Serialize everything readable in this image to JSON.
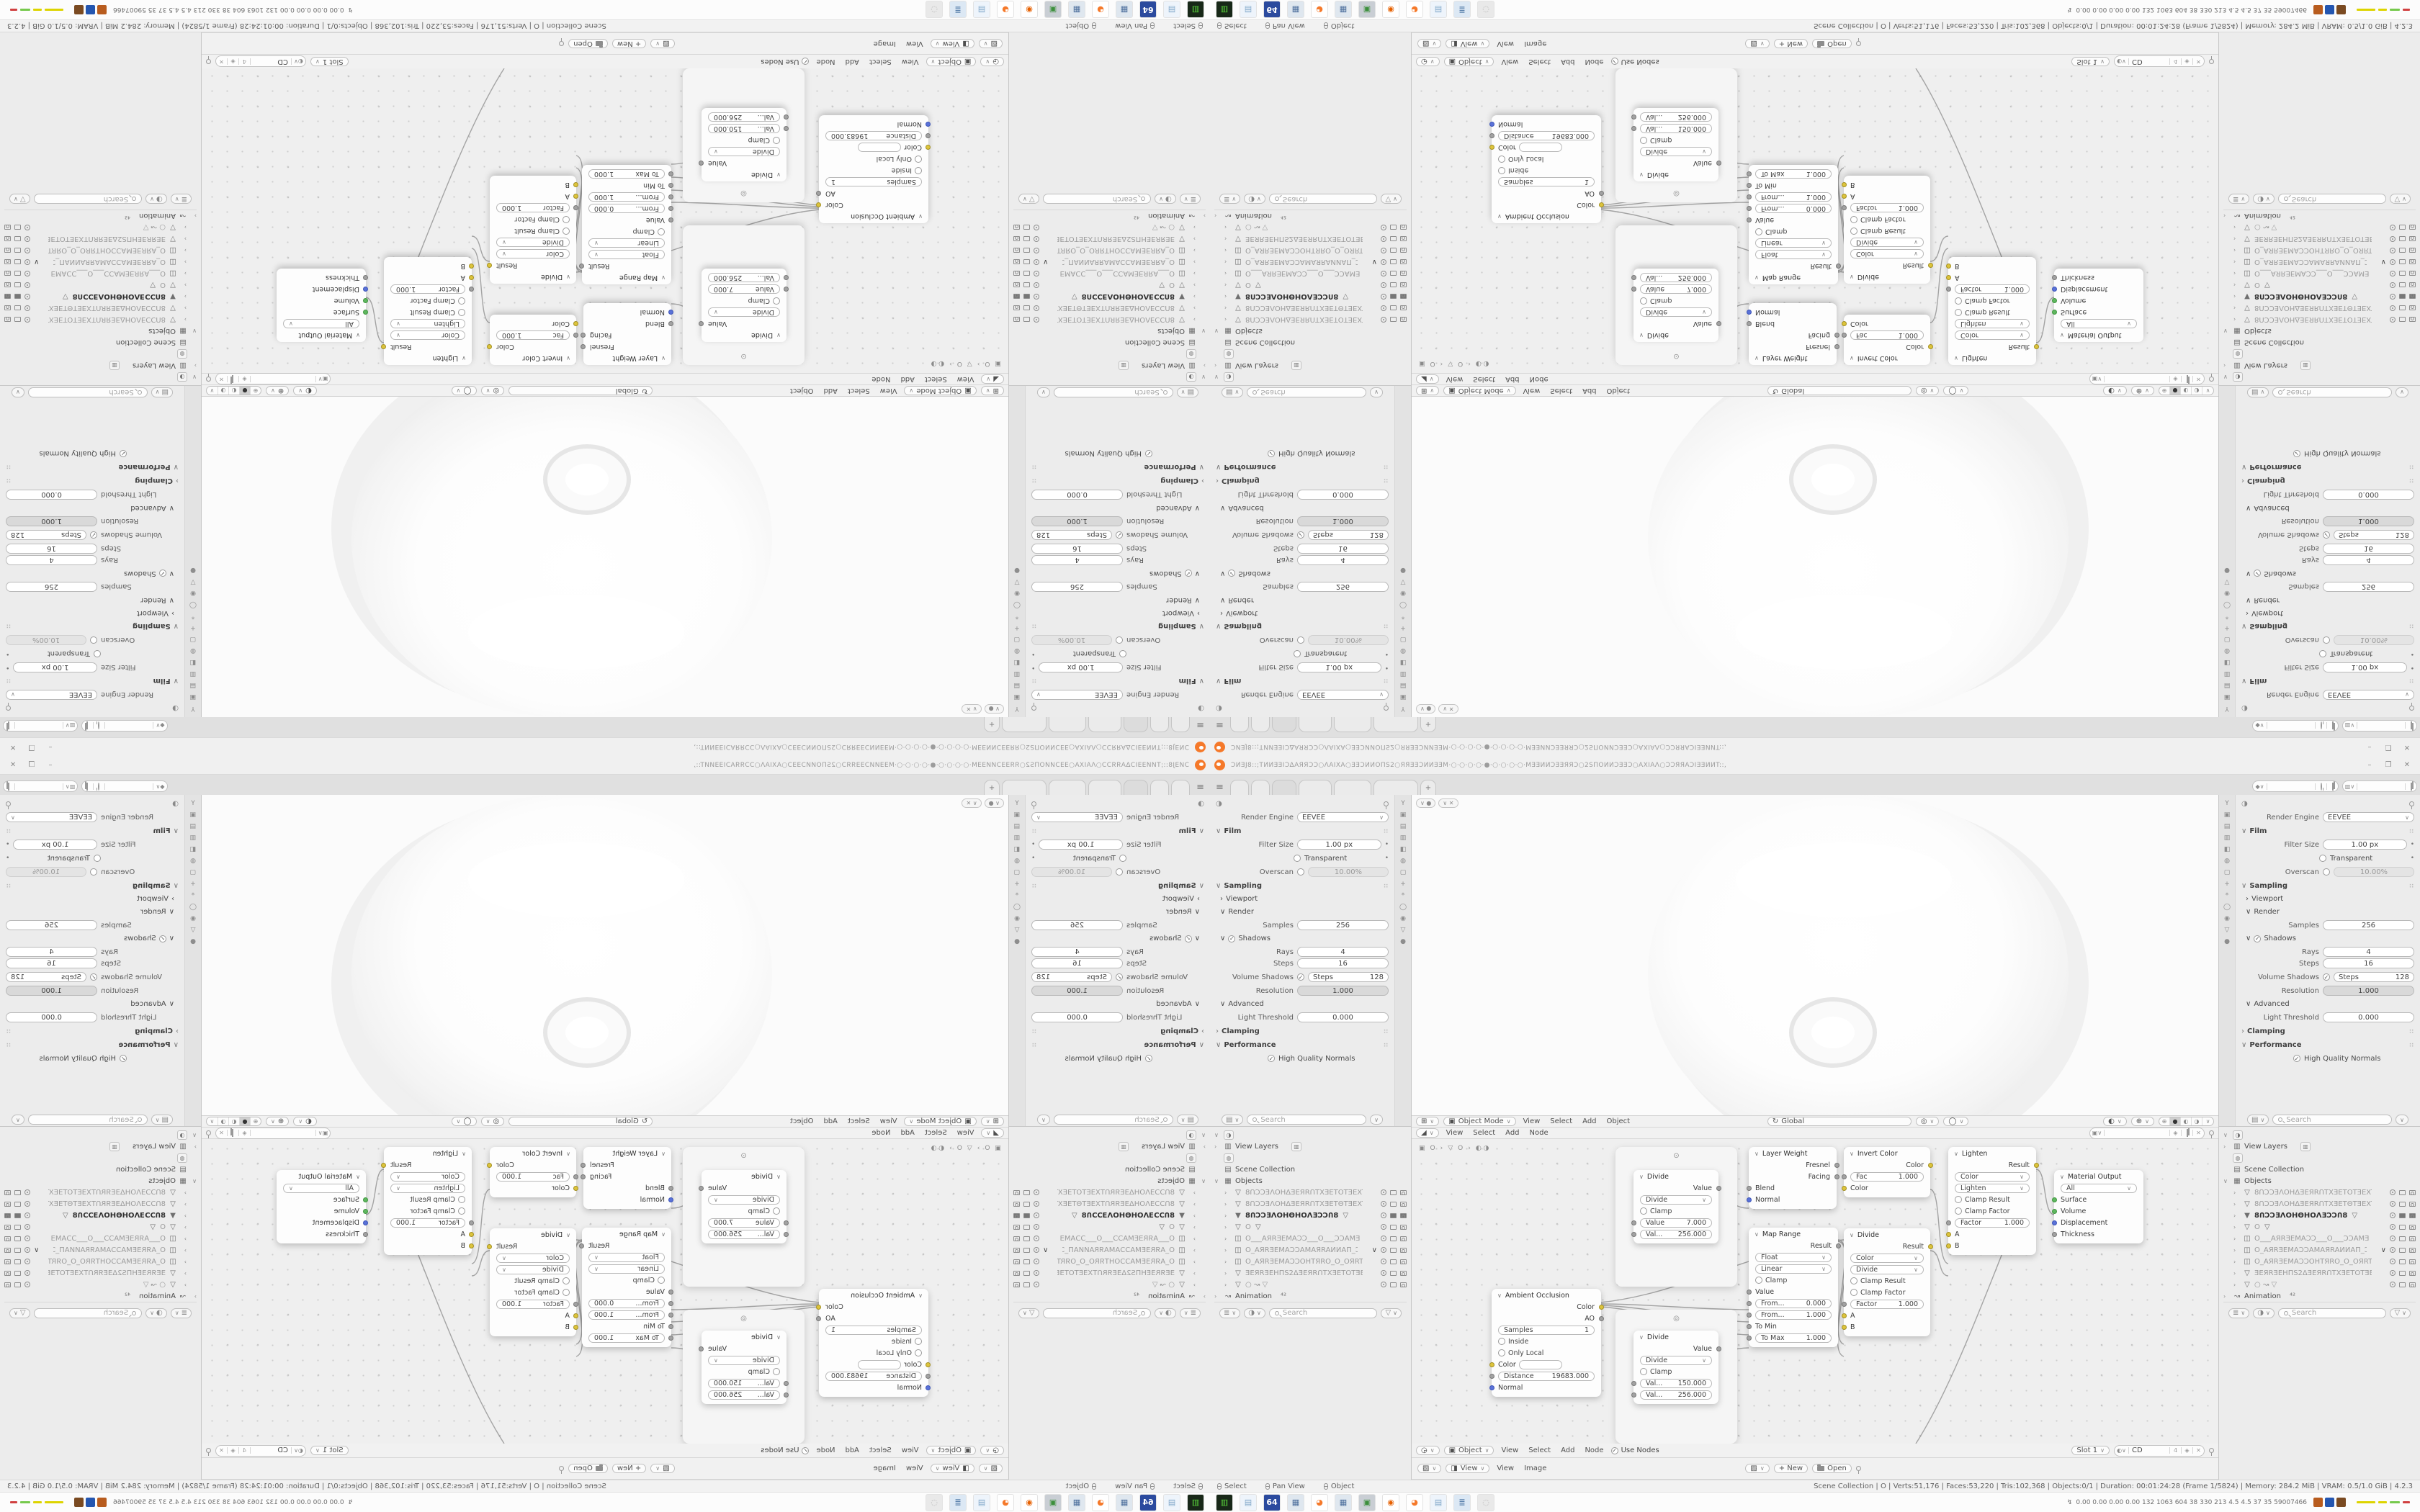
{
  "window": {
    "title": "ƆИƎJ8::;TИИƎƎIƆΔAЯЯƆƆ○ΛAIXA○ƎƎƆИИOΠЅ2○ЯЯƎƎƆИИƎƎM·○·○·○·○·●·○·○·○·○·MƎƎИИƆƎƎЯЯƆ○2ЅΠOИИƆƎƎƆ○AXIAΛ○ƆƆЯЯAƆIƎƎИИT::,",
    "minimize": "–",
    "maximize": "❐",
    "close": "✕"
  },
  "topbar": {
    "menu_icon": "≡",
    "new_tab": "+"
  },
  "props": {
    "render_engine": {
      "label": "Render Engine",
      "value": "EEVEE"
    },
    "film": {
      "label": "Film"
    },
    "filter_size": {
      "label": "Filter Size",
      "value": "1.00 px"
    },
    "transparent": {
      "label": "Transparent"
    },
    "overscan": {
      "label": "Overscan",
      "value": "10.00%"
    },
    "sampling": {
      "label": "Sampling"
    },
    "viewport": {
      "label": "Viewport"
    },
    "render": {
      "label": "Render"
    },
    "samples": {
      "label": "Samples",
      "value": "256"
    },
    "shadows": {
      "label": "Shadows"
    },
    "rays": {
      "label": "Rays",
      "value": "4"
    },
    "steps": {
      "label": "Steps",
      "value": "16"
    },
    "volume_shadows": {
      "label": "Volume Shadows",
      "steps_label": "Steps",
      "value": "128"
    },
    "resolution": {
      "label": "Resolution",
      "value": "1.000"
    },
    "advanced": {
      "label": "Advanced"
    },
    "light_threshold": {
      "label": "Light Threshold",
      "value": "0.000"
    },
    "clamping": {
      "label": "Clamping"
    },
    "performance": {
      "label": "Performance"
    },
    "hq_normals": {
      "label": "High Quality Normals"
    },
    "search_placeholder": "Search",
    "tab_icons": [
      {
        "name": "tool-icon",
        "glyph": "Y"
      },
      {
        "name": "render-icon",
        "glyph": "▣"
      },
      {
        "name": "output-icon",
        "glyph": "▤"
      },
      {
        "name": "viewlayer-icon",
        "glyph": "▥"
      },
      {
        "name": "scene-icon",
        "glyph": "◧"
      },
      {
        "name": "world-icon",
        "glyph": "◍"
      },
      {
        "name": "object-icon",
        "glyph": "▢"
      },
      {
        "name": "modifier-icon",
        "glyph": "+"
      },
      {
        "name": "particles-icon",
        "glyph": "*"
      },
      {
        "name": "physics-icon",
        "glyph": "◯"
      },
      {
        "name": "constraints-icon",
        "glyph": "◉"
      },
      {
        "name": "data-icon",
        "glyph": "▽"
      },
      {
        "name": "material-icon",
        "glyph": "●"
      }
    ]
  },
  "outliner": {
    "view_layers": "View Layers",
    "scene_collection": "Scene Collection",
    "objects_label": "Objects",
    "animation": "Animation",
    "animation_badge": "⁴²",
    "search_placeholder": "Search",
    "objects": [
      {
        "type": "▽",
        "name": "8ՈƆƆƎΛOHΔƎEЯRՈTXƎETOTƎEXT",
        "eye": "",
        "cls": ""
      },
      {
        "type": "▽",
        "name": "8ՈƆƆƎΛOHΔƎEЯRՈTXƎETΘTƎEXT",
        "eye": "",
        "cls": ""
      },
      {
        "type": "▼",
        "name": "8ՈƆƆƎΛOHΘHOΛƎƆƆՈ8",
        "eye": "",
        "cls": "sel",
        "extra": "▽"
      },
      {
        "type": "▽",
        "name": "O",
        "eye": "",
        "cls": "",
        "extra": "▽"
      },
      {
        "type": "◫",
        "name": "O___AЯRƎEMAƆƆ___O___ƆƆAMƎ",
        "eye": "",
        "cls": ""
      },
      {
        "type": "◫",
        "name": "O_AЯRƎEMAƆƆAMAЯRAИИAΠ_Ɔ",
        "eye": "∨",
        "cls": ""
      },
      {
        "type": "◫",
        "name": "O_AЯRƎEMAƆƆOHTЯRO_O_OЯRTH",
        "eye": "",
        "cls": ""
      },
      {
        "type": "▽",
        "name": "ƎEЯRƎEHΠЅ2ΔƎEЯRՈTXƎETOTƎEXT",
        "eye": "",
        "cls": ""
      },
      {
        "type": "▽",
        "name": "○  ↝ ▽",
        "eye": "",
        "cls": ""
      }
    ]
  },
  "viewport_header": {
    "mode": "Object Mode",
    "menus": {
      "view": "View",
      "select": "Select",
      "add": "Add",
      "object": "Object"
    },
    "transform_orientation": "Global"
  },
  "node_header": {
    "menus": {
      "view": "View",
      "select": "Select",
      "add": "Add",
      "node": "Node"
    }
  },
  "breadcrumb": {
    "object": "O",
    "material": "O"
  },
  "nodes": {
    "ao": {
      "title": "Ambient Occlusion",
      "out_color": "Color",
      "out_ao": "AO",
      "samples_label": "Samples",
      "samples_value": "1",
      "inside": "Inside",
      "only_local": "Only Local",
      "color_label": "Color",
      "distance_label": "Distance",
      "distance_value": "19683.000",
      "normal": "Normal"
    },
    "divide1": {
      "title": "Divide",
      "out": "Value",
      "op": "Divide",
      "clamp": "Clamp",
      "v1_label": "Value",
      "v1": "7.000",
      "v2_label": "Val...",
      "v2": "256.000"
    },
    "divide2": {
      "title": "Divide",
      "out": "Value",
      "op": "Divide",
      "clamp": "Clamp",
      "v1_label": "Val...",
      "v1": "150.000",
      "v2_label": "Val...",
      "v2": "256.000"
    },
    "layer_weight": {
      "title": "Layer Weight",
      "out1": "Fresnel",
      "out2": "Facing",
      "in1": "Blend",
      "in2": "Normal"
    },
    "map_range": {
      "title": "Map Range",
      "out": "Result",
      "type": "Float",
      "interp": "Linear",
      "clamp": "Clamp",
      "value": "Value",
      "from_min_label": "From...",
      "from_min": "0.000",
      "from_max_label": "From...",
      "from_max": "1.000",
      "to_min": "To Min",
      "to_max_label": "To Max",
      "to_max": "1.000"
    },
    "invert": {
      "title": "Invert Color",
      "out": "Color",
      "fac_label": "Fac",
      "fac": "1.000",
      "in": "Color"
    },
    "divide_mix": {
      "title": "Divide",
      "out": "Result",
      "mode": "Color",
      "op": "Divide",
      "clamp_result": "Clamp Result",
      "clamp_factor": "Clamp Factor",
      "factor_label": "Factor",
      "factor": "1.000",
      "a": "A",
      "b": "B"
    },
    "lighten": {
      "title": "Lighten",
      "out": "Result",
      "mode": "Color",
      "op": "Lighten",
      "clamp_result": "Clamp Result",
      "clamp_factor": "Clamp Factor",
      "factor_label": "Factor",
      "factor": "1.000",
      "a": "A",
      "b": "B"
    },
    "material_output": {
      "title": "Material Output",
      "target": "All",
      "surface": "Surface",
      "volume": "Volume",
      "displacement": "Displacement",
      "thickness": "Thickness"
    }
  },
  "shader_header": {
    "context": "Object",
    "menus": {
      "view": "View",
      "select": "Select",
      "add": "Add",
      "node": "Node"
    },
    "use_nodes": "Use Nodes",
    "slot": "Slot 1",
    "material_name": "CD",
    "users_count": "4"
  },
  "image_header": {
    "view_menu": "View",
    "menus": {
      "view": "View",
      "image": "Image"
    },
    "new_label": "+ New",
    "open_label": "Open"
  },
  "statusbar": {
    "hints": {
      "select": "Select",
      "pan": "Pan View",
      "object": "Object"
    },
    "stats": "Scene Collection | O | Verts:51,176 | Faces:53,220 | Tris:102,368 | Objects:0/1 | Duration: 00:01:24:28 (Frame 1/5824) | Memory: 284.2 MiB | VRAM: 0.5/1.0 GiB | 4.2.3"
  },
  "taskbar": {
    "perf_numbers": "0.00 0.00 0.00 0.00 132 1063 604 38 330 213 4.5 4.5 37 35 59007466",
    "apps": [
      {
        "name": "drive-app",
        "bg": "#14221247",
        "glyph": "▥",
        "fg": "#58d33a",
        "bgc": "#182818"
      },
      {
        "name": "notepad-app",
        "glyph": "▤",
        "fg": "#7fa6c8",
        "bgc": "#eef4fb"
      },
      {
        "name": "floppy64-app",
        "glyph": "64",
        "fg": "#ffffff",
        "bgc": "#2b4a9e"
      },
      {
        "name": "calculator-app",
        "glyph": "▦",
        "fg": "#4a6c9b",
        "bgc": "#dfe7ef"
      },
      {
        "name": "blender-app",
        "glyph": "◕",
        "fg": "#f5792a",
        "bgc": "#ffffff"
      },
      {
        "name": "calculator2-app",
        "glyph": "▦",
        "fg": "#4a6c9b",
        "bgc": "#dfe7ef"
      },
      {
        "name": "pc-monitor-app",
        "glyph": "▣",
        "fg": "#3c8f3c",
        "bgc": "#c9ced4"
      },
      {
        "name": "firefox-app",
        "glyph": "◉",
        "fg": "#e66000",
        "bgc": "#ffffff"
      },
      {
        "name": "blender2-app",
        "glyph": "◕",
        "fg": "#f5792a",
        "bgc": "#ffffff"
      },
      {
        "name": "notepad2-app",
        "glyph": "▤",
        "fg": "#7fa6c8",
        "bgc": "#eef4fb"
      },
      {
        "name": "documents-app",
        "glyph": "≣",
        "fg": "#5b82ad",
        "bgc": "#dce8f4"
      },
      {
        "name": "gimp-disabled-app",
        "glyph": "◌",
        "fg": "#b5b5b5",
        "bgc": "#e9e9e9"
      }
    ],
    "tray_colors": [
      "#b85c1e",
      "#2456b0",
      "#7a4a21"
    ],
    "dash_colors": [
      "#ddd400",
      "#ddd400",
      "#76c94c",
      "#d04040"
    ]
  }
}
